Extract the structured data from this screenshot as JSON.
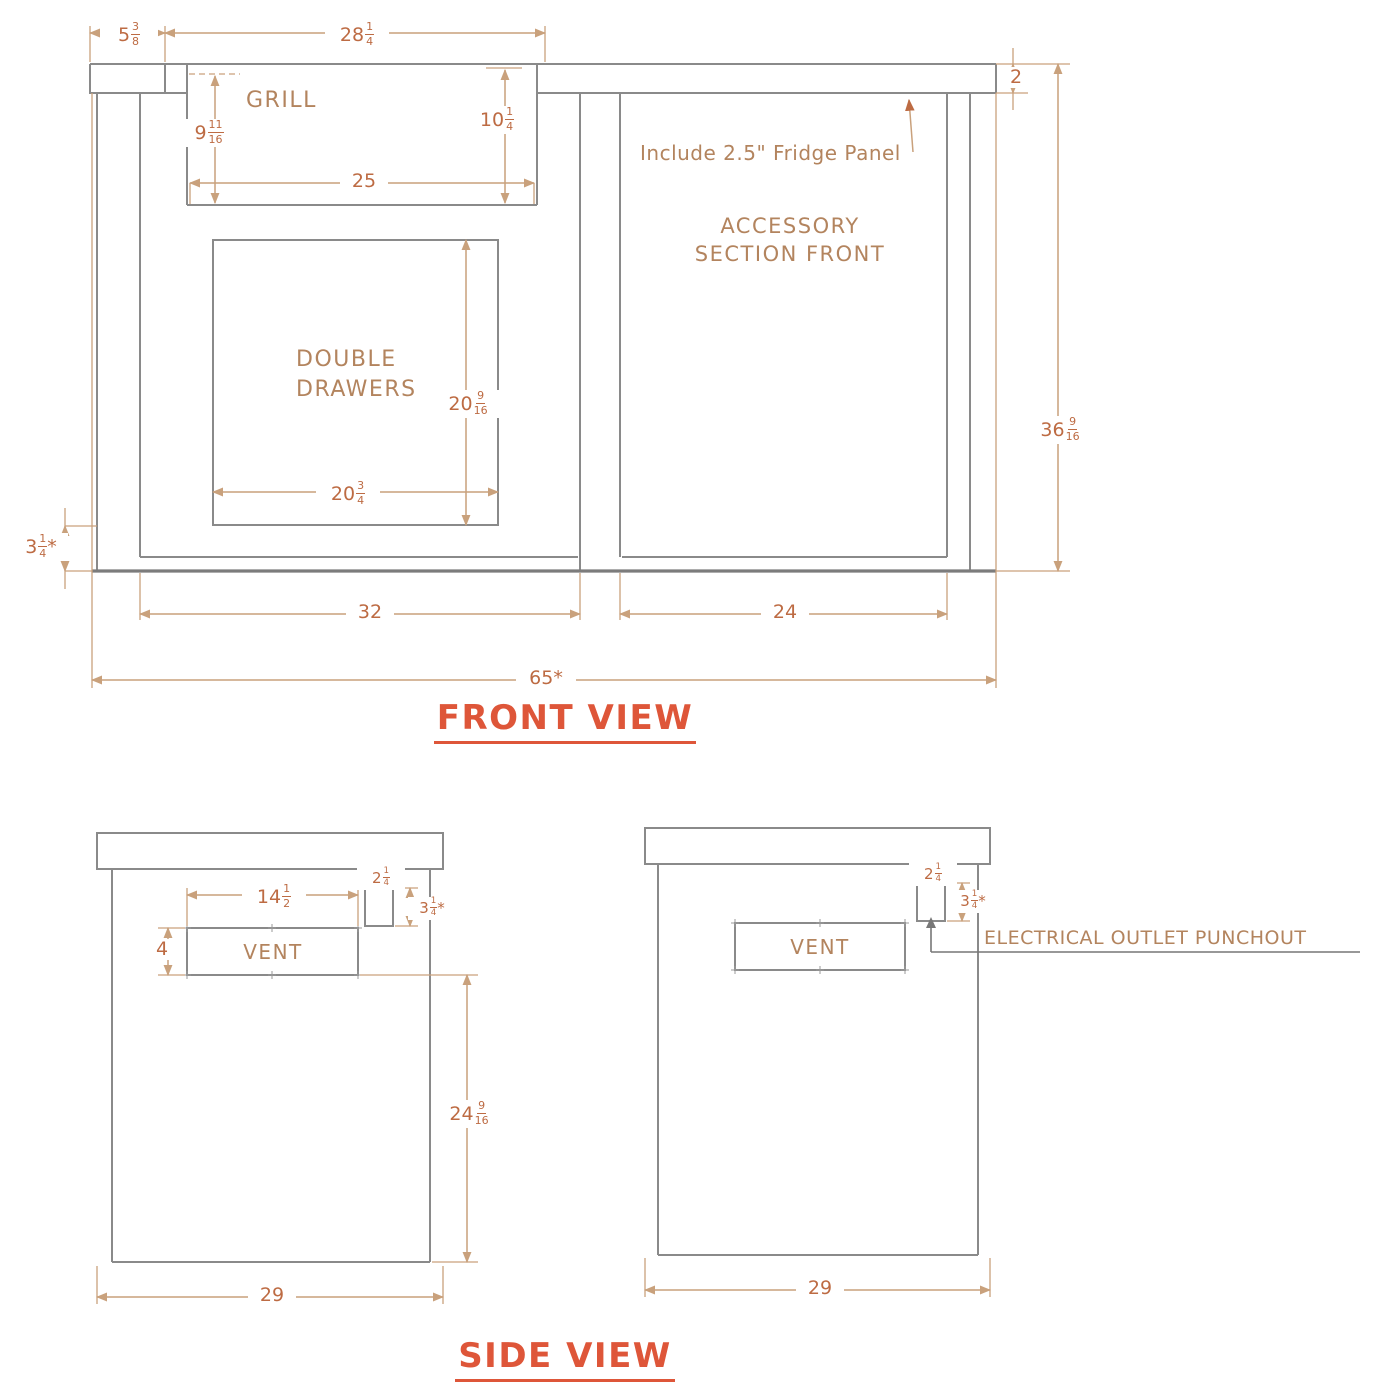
{
  "titles": {
    "front": "FRONT VIEW",
    "side": "SIDE VIEW"
  },
  "colors": {
    "structure_line": "#8a8a8a",
    "dimension_line": "#c9a17c",
    "dimension_text": "#bd6b43",
    "label_text": "#b3845e",
    "title_text": "#de5639"
  },
  "front_view": {
    "labels": {
      "grill": "GRILL",
      "double_drawers": "DOUBLE\nDRAWERS",
      "accessory_section": "ACCESSORY\nSECTION FRONT",
      "fridge_note": "Include 2.5\" Fridge Panel"
    },
    "dimensions": {
      "end_panel_width": "5 3/8",
      "grill_cutout_width": "28 1/4",
      "grill_depth_left": "9 11/16",
      "grill_depth_right": "10 1/4",
      "grill_width": "25",
      "countertop_thickness": "2",
      "drawer_opening_height": "20 9/16",
      "drawer_opening_width": "20 3/4",
      "base_height": "3 1/4*",
      "overall_height": "36 9/16",
      "grill_section_width": "32",
      "accessory_section_width": "24",
      "overall_width": "65*"
    }
  },
  "side_view_left": {
    "labels": {
      "vent": "VENT"
    },
    "dimensions": {
      "vent_width": "14 1/2",
      "vent_height": "4",
      "punchout_width": "2 1/4",
      "punchout_height": "3 1/4*",
      "vent_to_base": "24 9/16",
      "depth": "29"
    }
  },
  "side_view_right": {
    "labels": {
      "vent": "VENT",
      "punchout": "ELECTRICAL OUTLET PUNCHOUT"
    },
    "dimensions": {
      "punchout_width": "2 1/4",
      "punchout_height": "3 1/4*",
      "depth": "29"
    }
  }
}
